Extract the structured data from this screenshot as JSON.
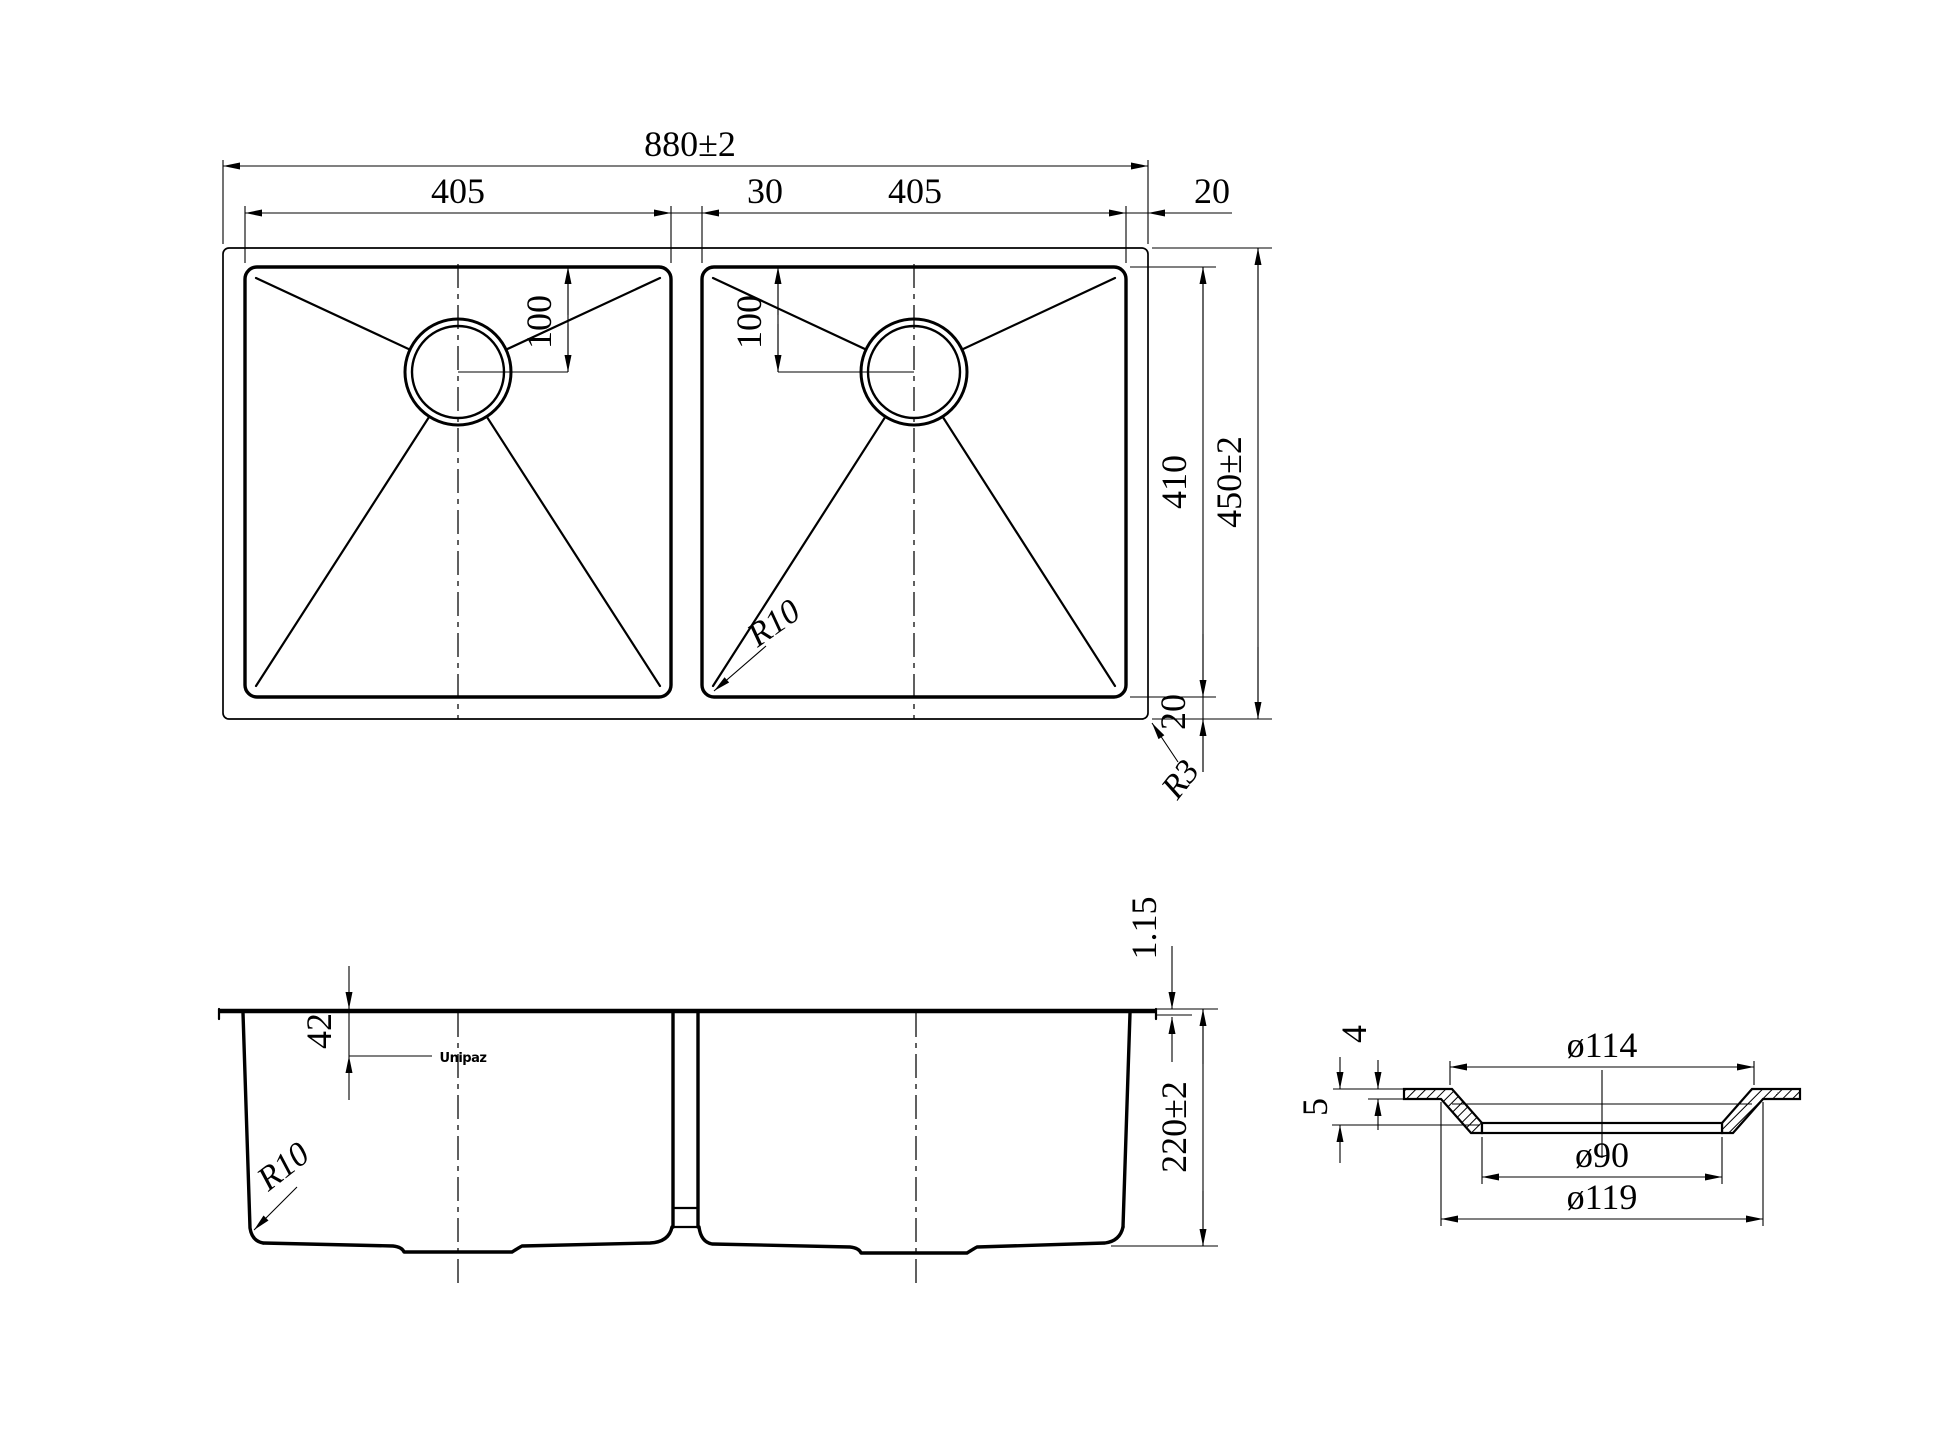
{
  "plan_view": {
    "overall_width": "880±2",
    "left_bowl_width": "405",
    "divider_width": "30",
    "right_bowl_width": "405",
    "right_edge": "20",
    "left_drain_offset": "100",
    "right_drain_offset": "100",
    "bowl_length": "410",
    "overall_length": "450±2",
    "bottom_edge": "20",
    "bowl_corner_radius": "R10",
    "outer_corner_radius": "R3"
  },
  "front_view": {
    "rim_thickness": "1.15",
    "logo_offset": "42",
    "overall_height": "220±2",
    "corner_radius": "R10",
    "brand_mark": "Unipaz"
  },
  "drain_detail": {
    "flange_lip": "4",
    "recess_depth": "5",
    "top_diameter": "ø114",
    "inner_diameter": "ø90",
    "outer_diameter": "ø119"
  }
}
